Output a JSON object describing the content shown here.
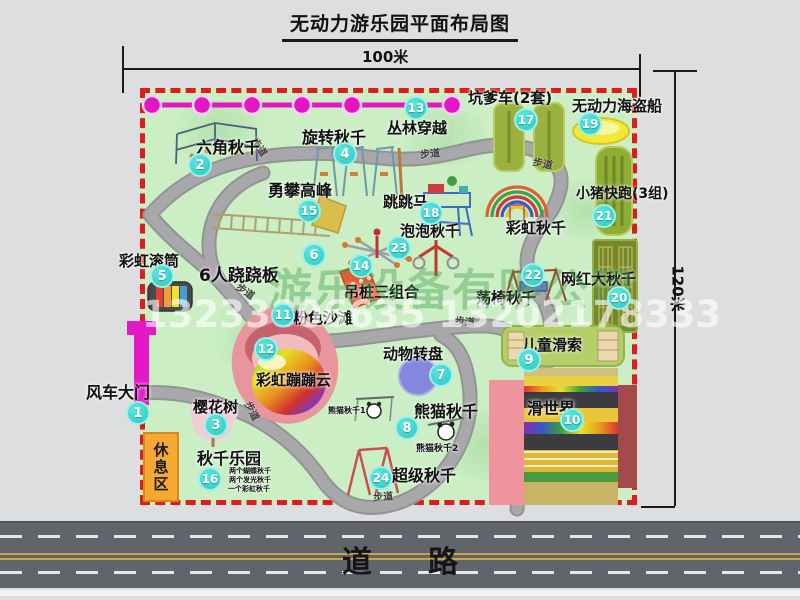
{
  "title": "无动力游乐园平面布局图",
  "dimensions": {
    "width_label": "100米",
    "height_label": "120米"
  },
  "road": {
    "label": "道路"
  },
  "watermark": {
    "company": "游乐设备有限公司",
    "phone": "13233806635 13202178333"
  },
  "walkway_label": "步道",
  "rest_area_label": "休息区",
  "rainbow_swing_label": "彩虹秋千",
  "attractions": [
    {
      "num": "1",
      "name": "风车大门"
    },
    {
      "num": "2",
      "name": "六角秋千"
    },
    {
      "num": "3",
      "name": "樱花树"
    },
    {
      "num": "4",
      "name": "旋转秋千"
    },
    {
      "num": "5",
      "name": "彩虹滚筒"
    },
    {
      "num": "6",
      "name": "6人跷跷板"
    },
    {
      "num": "7",
      "name": "动物转盘"
    },
    {
      "num": "8",
      "name": "熊猫秋千",
      "sub_labels": [
        "熊猫秋千1",
        "熊猫秋千2"
      ]
    },
    {
      "num": "9",
      "name": "儿童滑索"
    },
    {
      "num": "10",
      "name": "滑世界"
    },
    {
      "num": "11",
      "name": "粉色沙滩"
    },
    {
      "num": "12",
      "name": "彩虹蹦蹦云"
    },
    {
      "num": "13",
      "name": "丛林穿越"
    },
    {
      "num": "14",
      "name": "吊桩三组合"
    },
    {
      "num": "15",
      "name": "勇攀高峰"
    },
    {
      "num": "16",
      "name": "秋千乐园",
      "notes": [
        "两个蝴蝶秋千",
        "两个发光秋千",
        "一个彩虹秋千"
      ]
    },
    {
      "num": "17",
      "name": "坑爹车(2套)"
    },
    {
      "num": "18",
      "name": "跳跳马"
    },
    {
      "num": "19",
      "name": "无动力海盗船"
    },
    {
      "num": "20",
      "name": "网红大秋千"
    },
    {
      "num": "21",
      "name": "小猪快跑(3组)"
    },
    {
      "num": "22",
      "name": "荡椅秋千"
    },
    {
      "num": "23",
      "name": "泡泡秋千"
    },
    {
      "num": "24",
      "name": "超级秋千"
    }
  ],
  "colors": {
    "map_green": "#cbeec5",
    "border_red": "#dd1d1d",
    "badge_teal": "#2cc9c1",
    "zipline_magenta": "#e515c5",
    "gate_magenta": "#e518c8",
    "rest_area_orange": "#f5a832",
    "road_gray": "#62646c"
  }
}
